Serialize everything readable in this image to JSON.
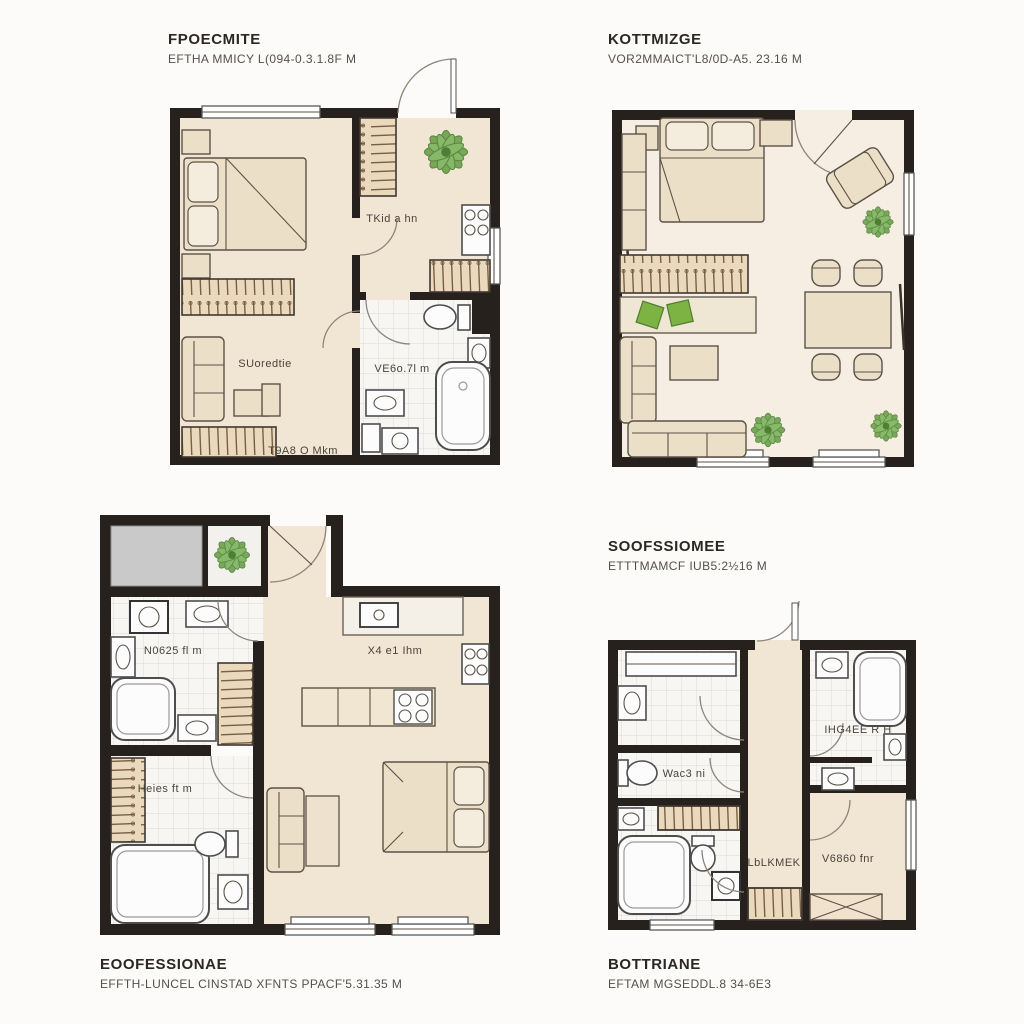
{
  "colors": {
    "wall": "#26211d",
    "floor_beige": "#f1e5d4",
    "floor_cream": "#f6eee2",
    "tile": "#f7f6f3",
    "furniture": "#ecdfc8",
    "fixture_white": "#fcfcfc",
    "plant_green": "#6da04b",
    "cushion_green": "#7cb342",
    "balcony_gray": "#c9c9c9"
  },
  "plans": {
    "top_left": {
      "title": "FPOECMITE",
      "subtitle": "EFTHA MMICY L(094-0.3.1.8F M",
      "labels": {
        "kitchen": "TKid a hn",
        "living": "SUoredtie",
        "bathroom": "VE6o.7l m",
        "wardrobe": "T9A8 O Mkm"
      }
    },
    "top_right": {
      "title": "KOTTMIZGE",
      "subtitle": "VOR2MMAICT'L8/0D-A5. 23.16 M"
    },
    "bottom_left": {
      "labels": {
        "bath_top": "N0625 fl m",
        "bath_bottom": "Heies ft m",
        "kitchen": "X4 e1 Ihm"
      },
      "caption_title": "EOOFESSIONAE",
      "caption_subtitle": "EFFTH-LUNCEL CINSTAD XFNTS PPACF'5.31.35 M"
    },
    "bottom_right": {
      "title": "SOOFSSIOMEE",
      "subtitle": "ETTTMAMCF IUB5:2½16 M",
      "labels": {
        "bath": "IHG4EE R H",
        "wc": "Wac3 ni",
        "closet": "LbLKMEK",
        "room": "V6860 fnr"
      },
      "caption_title": "BOTTRIANE",
      "caption_subtitle": "EFTAM MGSEDDL.8 34-6E3"
    }
  }
}
